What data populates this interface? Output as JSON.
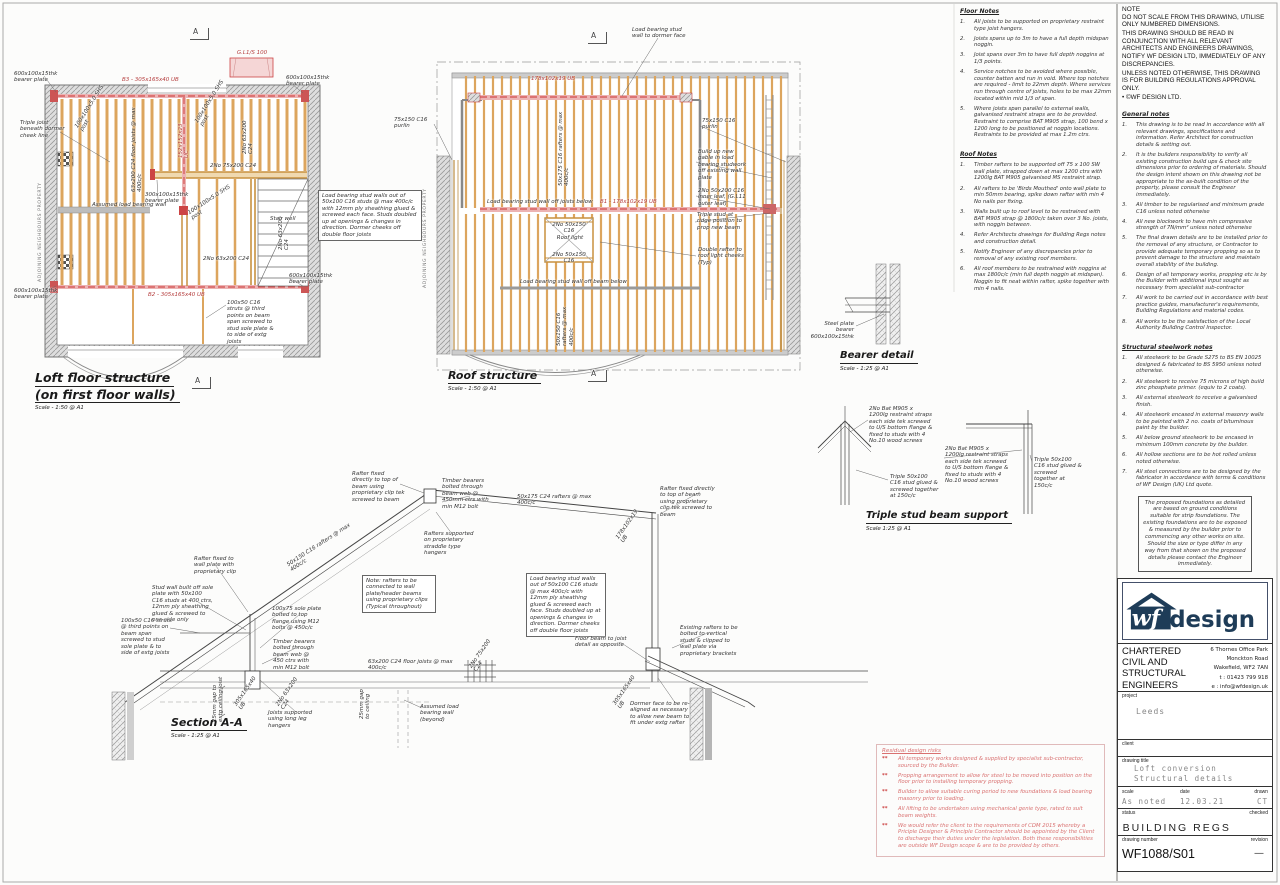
{
  "loft": {
    "title_line1": "Loft floor structure",
    "title_line2": "(on first floor walls)",
    "scale_label": "Scale - 1:50 @ A1",
    "annotations": [
      {
        "t": "600x100x15thk bearer plate",
        "x": 14,
        "y": 71,
        "w": 44,
        "n": "bearer-plate-label"
      },
      {
        "t": "600x100x15thk bearer plate",
        "x": 286,
        "y": 75,
        "w": 46,
        "n": "bearer-plate-label"
      },
      {
        "t": "600x100x15thk bearer plate",
        "x": 14,
        "y": 288,
        "w": 44,
        "n": "bearer-plate-label"
      },
      {
        "t": "600x100x15thk bearer plate",
        "x": 289,
        "y": 273,
        "w": 46,
        "n": "bearer-plate-label"
      },
      {
        "t": "Triple joist beneath dormer cheek line",
        "x": 20,
        "y": 120,
        "w": 46,
        "n": "triple-joist-label"
      },
      {
        "t": "ADJOINING NEIGHBOURS PROPERTY",
        "x": 38,
        "y": 282,
        "rot": -90,
        "w": 110,
        "cls": "tiny",
        "n": "boundary-label"
      },
      {
        "t": "B3 - 305x165x40 UB",
        "x": 122,
        "y": 77,
        "w": 70,
        "cls": "red",
        "n": "beam-b3-label"
      },
      {
        "t": "B2 - 305x165x40 UB",
        "x": 148,
        "y": 292,
        "w": 70,
        "cls": "red",
        "n": "beam-b2-label"
      },
      {
        "t": "G.L1/S 100",
        "x": 231,
        "y": 50,
        "w": 42,
        "cls": "red",
        "ta": "center",
        "n": "lintel-label"
      },
      {
        "t": "63x200 C24 floor joists @ max 400c/c",
        "x": 131,
        "y": 192,
        "rot": -90,
        "w": 86,
        "n": "floor-joists-label"
      },
      {
        "t": "100x100x5.0 SHS post",
        "x": 74,
        "y": 126,
        "rot": -58,
        "w": 58,
        "n": "shs-post-label"
      },
      {
        "t": "100x100x5.0 SHS post",
        "x": 194,
        "y": 121,
        "rot": -58,
        "w": 58,
        "n": "shs-post-label"
      },
      {
        "t": "152x152x23 UC",
        "x": 178,
        "y": 158,
        "rot": -90,
        "w": 42,
        "cls": "red",
        "n": "beam-label"
      },
      {
        "t": "2No 63x200 C24",
        "x": 242,
        "y": 154,
        "rot": -90,
        "w": 44,
        "n": "double-joist-label"
      },
      {
        "t": "2No 63x200 C24",
        "x": 278,
        "y": 250,
        "rot": -90,
        "w": 44,
        "n": "double-joist-label"
      },
      {
        "t": "2No 63x200 C24",
        "x": 203,
        "y": 256,
        "w": 48,
        "n": "double-joist-label"
      },
      {
        "t": "2No 75x200 C24",
        "x": 210,
        "y": 163,
        "w": 52,
        "n": "double-beam-label"
      },
      {
        "t": "300x100x15thk bearer plate",
        "x": 145,
        "y": 192,
        "w": 40,
        "n": "bearer-plate-label"
      },
      {
        "t": "100x100x5.0 SHS post",
        "x": 187,
        "y": 211,
        "rot": -33,
        "w": 56,
        "n": "shs-post-label"
      },
      {
        "t": "Assumed load bearing wall",
        "x": 92,
        "y": 202,
        "w": 84,
        "n": "load-bearing-wall-label"
      },
      {
        "t": "Stair well",
        "x": 270,
        "y": 216,
        "w": 26,
        "n": "stair-well-label"
      },
      {
        "t": "100x50 C16 struts @ third points on beam span screwed to stud sole plate & to side of extg joists",
        "x": 227,
        "y": 300,
        "w": 48,
        "n": "struts-note"
      }
    ]
  },
  "roof": {
    "title": "Roof structure",
    "scale_label": "Scale - 1:50 @ A1",
    "annotations": [
      {
        "t": "Load bearing stud wall to dormer face",
        "x": 632,
        "y": 27,
        "w": 56,
        "n": "stud-wall-label"
      },
      {
        "t": "178x102x19 UB",
        "x": 531,
        "y": 76,
        "w": 52,
        "cls": "red",
        "n": "dormer-beam-label"
      },
      {
        "t": "75x150 C16 purlin",
        "x": 394,
        "y": 117,
        "w": 42,
        "n": "purlin-label"
      },
      {
        "t": "75x150 C16 purlin",
        "x": 702,
        "y": 118,
        "w": 42,
        "n": "purlin-label"
      },
      {
        "t": "50x175 C16 rafters @ max 400c/c",
        "x": 558,
        "y": 186,
        "rot": -90,
        "w": 80,
        "n": "rafters-label"
      },
      {
        "t": "Build up new gable in load bearing studwork off existing wall plate",
        "x": 698,
        "y": 149,
        "w": 52,
        "n": "gable-note"
      },
      {
        "t": "2No 50x200 C16 inner leaf, (G.L11 outer leaf)",
        "x": 698,
        "y": 188,
        "w": 60,
        "n": "inner-leaf-note"
      },
      {
        "t": "Triple stud at ridge position to prop new beam",
        "x": 697,
        "y": 212,
        "w": 48,
        "n": "triple-stud-note"
      },
      {
        "t": "Double rafter to roof light cheeks (Typ)",
        "x": 698,
        "y": 247,
        "w": 48,
        "n": "double-rafter-note"
      },
      {
        "t": "Load bearing stud wall off joists below",
        "x": 487,
        "y": 199,
        "w": 112,
        "n": "stud-wall-label"
      },
      {
        "t": "B1 - 178x102x19 UB",
        "x": 600,
        "y": 199,
        "w": 72,
        "cls": "red",
        "n": "beam-b1-label"
      },
      {
        "t": "2No 50x150 C16",
        "x": 546,
        "y": 222,
        "w": 46,
        "ta": "center",
        "n": "trimmer-label"
      },
      {
        "t": "Roof light",
        "x": 556,
        "y": 235,
        "w": 28,
        "ta": "center",
        "n": "roof-light-label"
      },
      {
        "t": "2No 50x150 C16",
        "x": 546,
        "y": 252,
        "w": 46,
        "ta": "center",
        "n": "trimmer-label"
      },
      {
        "t": "Load bearing stud wall off beam below",
        "x": 520,
        "y": 279,
        "w": 110,
        "n": "stud-wall-label"
      },
      {
        "t": "50x150 C16 rafters @ max 400c/c",
        "x": 556,
        "y": 346,
        "rot": -90,
        "w": 50,
        "n": "rafters-label"
      },
      {
        "t": "ADJOINING NEIGHBOURS PROPERTY",
        "x": 423,
        "y": 288,
        "rot": -90,
        "w": 110,
        "cls": "tiny",
        "n": "boundary-label"
      },
      {
        "t": "Load bearing stud walls out of 50x100 C16 studs @ max 400c/c with 12mm ply sheathing glued & screwed each face. Studs doubled up at openings & changes in direction. Dormer cheeks off double floor joists",
        "x": 318,
        "y": 190,
        "w": 96,
        "cls": "boxed",
        "n": "stud-wall-spec-note"
      }
    ]
  },
  "section": {
    "title": "Section A-A",
    "scale_label": "Scale - 1:25 @ A1",
    "annotations": [
      {
        "t": "Rafter fixed directly to top of beam using proprietary clip tek screwed to beam",
        "x": 352,
        "y": 471,
        "w": 54,
        "n": "rafter-fixing-note"
      },
      {
        "t": "Timber bearers bolted through beam web @ 450mm ctrs with min M12 bolt",
        "x": 442,
        "y": 478,
        "w": 54,
        "n": "bearer-bolt-note"
      },
      {
        "t": "50x175 C24 rafters @ max 400c/c",
        "x": 517,
        "y": 494,
        "w": 88,
        "n": "rafters-label"
      },
      {
        "t": "Rafter fixed directly to top of beam using proprietary clip tek screwed to beam",
        "x": 660,
        "y": 486,
        "w": 56,
        "n": "rafter-fixing-note"
      },
      {
        "t": "Rafters supported on proprietary straddle type hangers",
        "x": 424,
        "y": 531,
        "w": 52,
        "n": "straddle-hanger-note"
      },
      {
        "t": "Note: rafters to be connected to wall plate/header beams using proprietary clips (Typical throughout)",
        "x": 362,
        "y": 575,
        "w": 66,
        "cls": "boxed",
        "n": "rafter-clip-note"
      },
      {
        "t": "Load bearing stud walls out of 50x100 C16 studs @ max 400c/c with 12mm ply sheathing glued & screwed each face. Studs doubled up at openings & changes in direction. Dormer cheeks off double floor joists",
        "x": 526,
        "y": 573,
        "w": 72,
        "cls": "boxed",
        "n": "stud-wall-spec-note"
      },
      {
        "t": "50x150 C16 rafters @ max 400c/c",
        "x": 286,
        "y": 563,
        "rot": -33,
        "w": 82,
        "n": "rafters-label"
      },
      {
        "t": "Rafter fixed to wall plate with proprietary clip",
        "x": 194,
        "y": 556,
        "w": 50,
        "n": "rafter-fixing-note"
      },
      {
        "t": "Stud wall built off sole plate with 50x100 C16 studs at 400 ctrs, 12mm ply sheathing glued & screwed to one side only",
        "x": 152,
        "y": 585,
        "w": 62,
        "n": "stud-wall-note"
      },
      {
        "t": "100x50 C16 struts @ third points on beam span screwed to stud sole plate & to side of extg joists",
        "x": 121,
        "y": 618,
        "w": 52,
        "n": "struts-note"
      },
      {
        "t": "100x75 sole plate bolted to top flange using M12 bolts @ 450c/c",
        "x": 272,
        "y": 606,
        "w": 50,
        "n": "sole-plate-note"
      },
      {
        "t": "Timber bearers bolted through beam web @ 450 ctrs with min M12 bolt",
        "x": 273,
        "y": 639,
        "w": 48,
        "n": "bearer-bolt-note"
      },
      {
        "t": "Joists supported using long leg hangers",
        "x": 268,
        "y": 710,
        "w": 50,
        "n": "joist-hanger-note"
      },
      {
        "t": "305x165x40 UB",
        "x": 233,
        "y": 704,
        "rot": -55,
        "w": 42,
        "n": "beam-label"
      },
      {
        "t": "2No 63x200 C24",
        "x": 275,
        "y": 704,
        "rot": -55,
        "w": 44,
        "n": "double-joist-label"
      },
      {
        "t": "25mm gap to extg ceiling joist",
        "x": 212,
        "y": 722,
        "rot": -90,
        "w": 46,
        "n": "gap-dimension"
      },
      {
        "t": "63x200 C24 floor joists @ max 400c/c",
        "x": 368,
        "y": 659,
        "w": 92,
        "n": "floor-joists-label"
      },
      {
        "t": "2No 75x200 C24",
        "x": 468,
        "y": 666,
        "rot": -55,
        "w": 44,
        "n": "double-beam-label"
      },
      {
        "t": "25mm gap to ceiling",
        "x": 359,
        "y": 719,
        "rot": -90,
        "w": 32,
        "n": "gap-dimension"
      },
      {
        "t": "Assumed load bearing wall (beyond)",
        "x": 420,
        "y": 704,
        "w": 58,
        "n": "load-bearing-wall-label"
      },
      {
        "t": "Floor beam to joist detail as opposite",
        "x": 575,
        "y": 636,
        "w": 60,
        "n": "floor-beam-note"
      },
      {
        "t": "178x102x19 UB",
        "x": 615,
        "y": 537,
        "rot": -55,
        "w": 42,
        "n": "beam-label"
      },
      {
        "t": "Existing rafters to be bolted to vertical studs & clipped to wall plate via proprietary brackets",
        "x": 680,
        "y": 625,
        "w": 60,
        "n": "existing-rafters-note"
      },
      {
        "t": "305x165x40 UB",
        "x": 612,
        "y": 703,
        "rot": -55,
        "w": 42,
        "n": "beam-label"
      },
      {
        "t": "Dormer face to be re-aligned as necessary to allow new beam to fit under extg rafter",
        "x": 630,
        "y": 701,
        "w": 62,
        "n": "dormer-face-note"
      }
    ]
  },
  "bearer": {
    "title": "Bearer detail",
    "scale_label": "Scale - 1:25 @ A1",
    "annotations": [
      {
        "t": "Steel plate bearer 600x100x15thk",
        "x": 806,
        "y": 321,
        "w": 48,
        "ta": "right",
        "n": "steel-plate-bearer-label"
      }
    ]
  },
  "triple": {
    "title": "Triple stud beam support",
    "scale_label": "Scale 1:25 @ A1",
    "annotations": [
      {
        "t": "2No Bat M905 x 1200lg restraint straps each side tek screwed to U/S bottom flange & fixed to studs with 4 No.10 wood screws",
        "x": 869,
        "y": 406,
        "w": 64,
        "n": "restraint-strap-note"
      },
      {
        "t": "Triple 50x100 C16 stud glued & screwed together at 150c/c",
        "x": 890,
        "y": 474,
        "w": 50,
        "n": "triple-stud-note"
      },
      {
        "t": "2No Bat M905 x 1200lg restraint straps each side tek screwed to U/S bottom flange & fixed to studs with 4 No.10 wood screws",
        "x": 945,
        "y": 446,
        "w": 64,
        "n": "restraint-strap-note"
      },
      {
        "t": "Triple 50x100 C16 stud glued & screwed together at 150c/c",
        "x": 1034,
        "y": 457,
        "w": 48,
        "n": "triple-stud-note"
      }
    ]
  },
  "markers": [
    {
      "t": "A",
      "x": 190,
      "y": 28,
      "cls": "flag",
      "n": "section-marker"
    },
    {
      "t": "A",
      "x": 588,
      "y": 32,
      "cls": "flag",
      "n": "section-marker"
    },
    {
      "t": "A",
      "x": 588,
      "y": 370,
      "cls": "flag",
      "n": "section-marker"
    },
    {
      "t": "A",
      "x": 192,
      "y": 377,
      "cls": "flag",
      "n": "section-marker"
    }
  ],
  "notes": {
    "floor": {
      "heading": "Floor Notes",
      "items": [
        "All joists to be supported on proprietary restraint type joist hangers.",
        "Joists spans up to 3m to have a full depth midspan noggin.",
        "Joist spans over 3m to have full depth noggins at 1/3 points.",
        "Service notches to be avoided where possible, counter batten and run in void. Where top notches are required - limit to 22mm depth. Where services run through centre of joists, holes to be max 22mm located within mid 1/3 of span.",
        "Where joists span parallel to external walls, galvanised restraint straps are to be provided. Restraint to comprise BAT M905 strap, 100 bend x 1200 long to be positioned at noggin locations. Restraints to be provided at max 1.2m ctrs."
      ]
    },
    "roof": {
      "heading": "Roof Notes",
      "items": [
        "Timber rafters to be supported off 75 x 100 SW wall plate, strapped down at max 1200 ctrs with 1200lg BAT M905 galvanised MS restraint strap.",
        "All rafters to be 'Birds Mouthed' onto wall plate to min 50mm bearing, spike down rafter with min 4 No nails per fixing.",
        "Walls built up to roof level to be restrained with BAT M905 strap @ 1800c/c taken over 3 No. joists, with noggin between.",
        "Refer Architects drawings for Building Regs notes and construction detail.",
        "Notify Engineer of any discrepancies prior to removal of any existing roof members.",
        "All roof members to be restrained with noggins at max 1800c/c (min full depth noggin at midspan). Noggin to fit neat within rafter, spike together with min 4 nails."
      ]
    },
    "note": {
      "title": "NOTE",
      "lines": [
        "DO NOT SCALE FROM THIS DRAWING, UTILISE ONLY NUMBERED DIMENSIONS.",
        "THIS DRAWING SHOULD BE READ IN CONJUNCTION WITH ALL RELEVANT ARCHITECTS AND ENGINEERS DRAWINGS, NOTIFY WF DESIGN LTD, IMMEDIATELY OF ANY DISCREPANCIES.",
        "UNLESS NOTED OTHERWISE, THIS DRAWING IS FOR BUILDING REGULATIONS APPROVAL ONLY.",
        "• ©WF DESIGN LTD."
      ]
    },
    "general": {
      "heading": "General notes",
      "items": [
        "This drawing is to be read in accordance with all relevant drawings, specifications and information. Refer Architect for construction details & setting out.",
        "It is the builders responsibility to verify all existing construction build ups & check site dimensions prior to ordering of materials. Should the design intent shown on this drawing not be appropriate to the as-built condition of the property, please consult the Engineer immediately.",
        "All timber to be regularised and minimum grade C16 unless noted otherwise",
        "All new blockwork to have min compressive strength of 7N/mm² unless noted otherwise",
        "The final drawn details are to be installed prior to the removal of any structure, or Contractor to provide adequate temporary propping so as to prevent damage to the structure and maintain overall stability of the building.",
        "Design of all temporary works, propping etc is by the Builder with additional input sought as necessary from specialist sub-contractor",
        "All work to be carried out in accordance with best practice guides, manufacturer's requirements, Building Regulations and material codes.",
        "All works to be the satisfaction of the Local Authority Building Control Inspector."
      ]
    },
    "steelwork": {
      "heading": "Structural steelwork notes",
      "items": [
        "All steelwork to be Grade S275 to BS EN 10025 designed & fabricated to BS 5950 unless noted otherwise.",
        "All steelwork to receive 75 microns of high build zinc phosphate primer. (equiv to 2 coats).",
        "All external steelwork to receive a galvanised finish.",
        "All steelwork encased in external masonry walls to be painted with 2 no. coats of bituminous paint by the builder.",
        "All below ground steelwork to be encased in minimum 100mm concrete by the builder.",
        "All hollow sections are to be hot rolled unless noted otherwise.",
        "All steel connections are to be designed by the fabricator in accordance with terms & conditions of WF Design (UK) Ltd quote."
      ]
    },
    "boxes": {
      "foundation": "The proposed foundations as detailed are based on ground conditions suitable for strip foundations. The existing foundations are to be exposed & measured by the builder prior to commencing any other works on site. Should the size or type differ in any way from that shown on the proposed details please contact the Engineer immediately.",
      "blockwork": "All new blockwork to have minimum compressive strength of 7N/mm²",
      "steel": "Steel connections to be designed & detailed by Fabricator"
    }
  },
  "risks": {
    "heading": "Residual design risks",
    "items": [
      "All temporary works designed & supplied by specialist sub-contractor, sourced by the Builder.",
      "Propping arrangement to allow for steel to be moved into position on the floor prior to installing temporary propping.",
      "Builder to allow suitable curing period to new foundations & load bearing masonry prior to loading.",
      "All lifting to be undertaken using mechanical genie type, rated to suit beam weights.",
      "We would refer the client to the requirements of CDM 2015 whereby a Priciple Designer & Principle Contractor should be appointed by the Client to discharge their duties under the legislation. Both these responsibilities are outside WF Design scope & are to be provided by others."
    ]
  },
  "titleblock": {
    "logo": {
      "wf": "wf",
      "design": "design"
    },
    "company_lines": [
      "CHARTERED",
      "CIVIL AND",
      "STRUCTURAL",
      "ENGINEERS"
    ],
    "address_lines": [
      "6 Thornes Office Park",
      "Monckton Road",
      "Wakefield, WF2 7AN",
      "t : 01423 799 918",
      "e : info@wfdesign.uk"
    ],
    "labels": {
      "project": "project",
      "client": "client",
      "drawing_title": "drawing title",
      "scale": "scale",
      "date": "date",
      "drawn": "drawn",
      "status": "status",
      "checked": "checked",
      "drawing_number": "drawing number",
      "revision": "revision"
    },
    "project": "Leeds",
    "drawing_title_1": "Loft conversion",
    "drawing_title_2": "Structural details",
    "scale": "As noted",
    "date": "12.03.21",
    "drawn": "CT",
    "status": "BUILDING REGS",
    "drawing_number": "WF1088/S01",
    "revision": "—"
  }
}
